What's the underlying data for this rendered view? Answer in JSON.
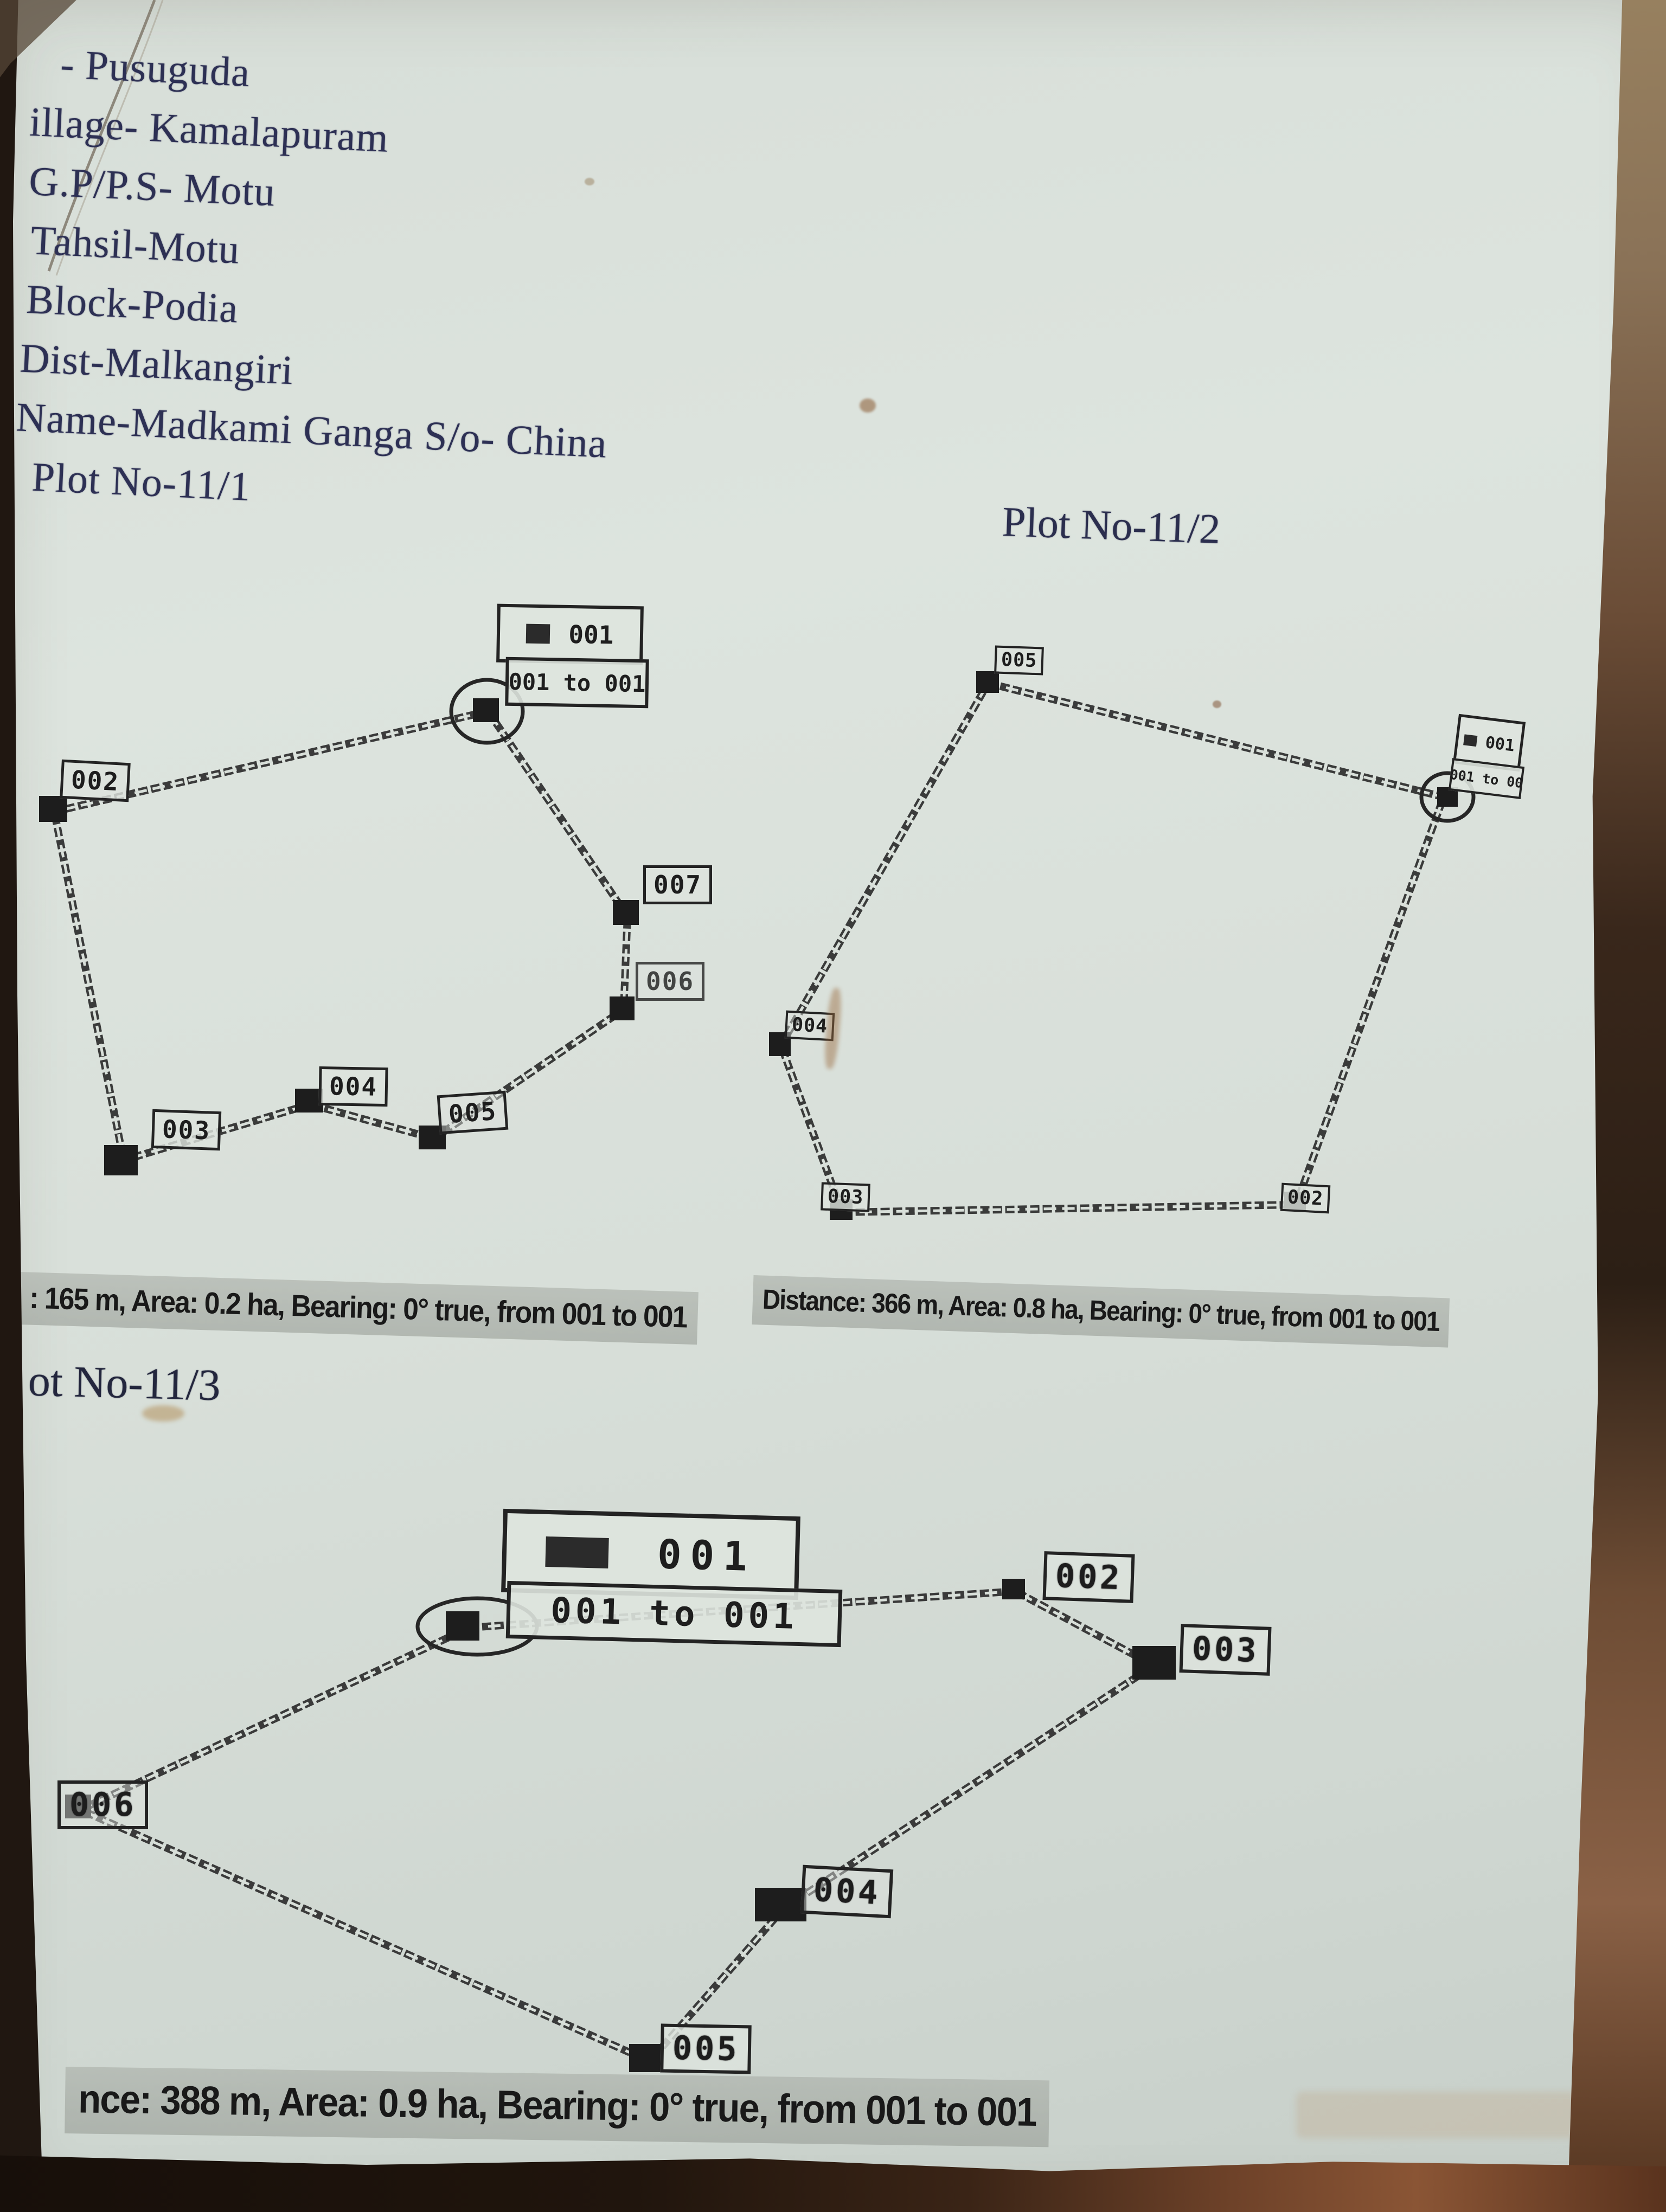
{
  "photo": {
    "paper_color": "#d8dfd9",
    "ink_color": "#2d3054",
    "print_color": "#232323",
    "highlight_color": "#a8ada6",
    "border_color": "#38281c"
  },
  "header": {
    "line1": "- Pusuguda",
    "line2": "illage- Kamalapuram",
    "line3": "G.P/P.S- Motu",
    "line4": "Tahsil-Motu",
    "line5": "Block-Podia",
    "line6": "Dist-Malkangiri",
    "line7": "Name-Madkami Ganga S/o- China",
    "line8": "Plot No-11/1"
  },
  "plot1": {
    "legend_point": "001",
    "legend_range": "001 to 001",
    "v002": "002",
    "v003": "003",
    "v004": "004",
    "v005": "005",
    "v006": "006",
    "v007": "007",
    "stats": ": 165 m, Area: 0.2 ha, Bearing: 0° true, from 001 to 001"
  },
  "plot2": {
    "title": "Plot No-11/2",
    "legend_point": "001",
    "legend_range": "001 to 00",
    "v002": "002",
    "v003": "003",
    "v004": "004",
    "v005": "005",
    "stats": "Distance: 366 m, Area: 0.8 ha, Bearing: 0° true, from 001 to 001"
  },
  "plot3": {
    "title": "ot No-11/3",
    "legend_point": "001",
    "legend_range": "001 to 001",
    "v002": "002",
    "v003": "003",
    "v004": "004",
    "v005": "005",
    "v006": "006",
    "stats": "nce: 388 m, Area: 0.9 ha, Bearing: 0° true, from 001 to 001"
  }
}
